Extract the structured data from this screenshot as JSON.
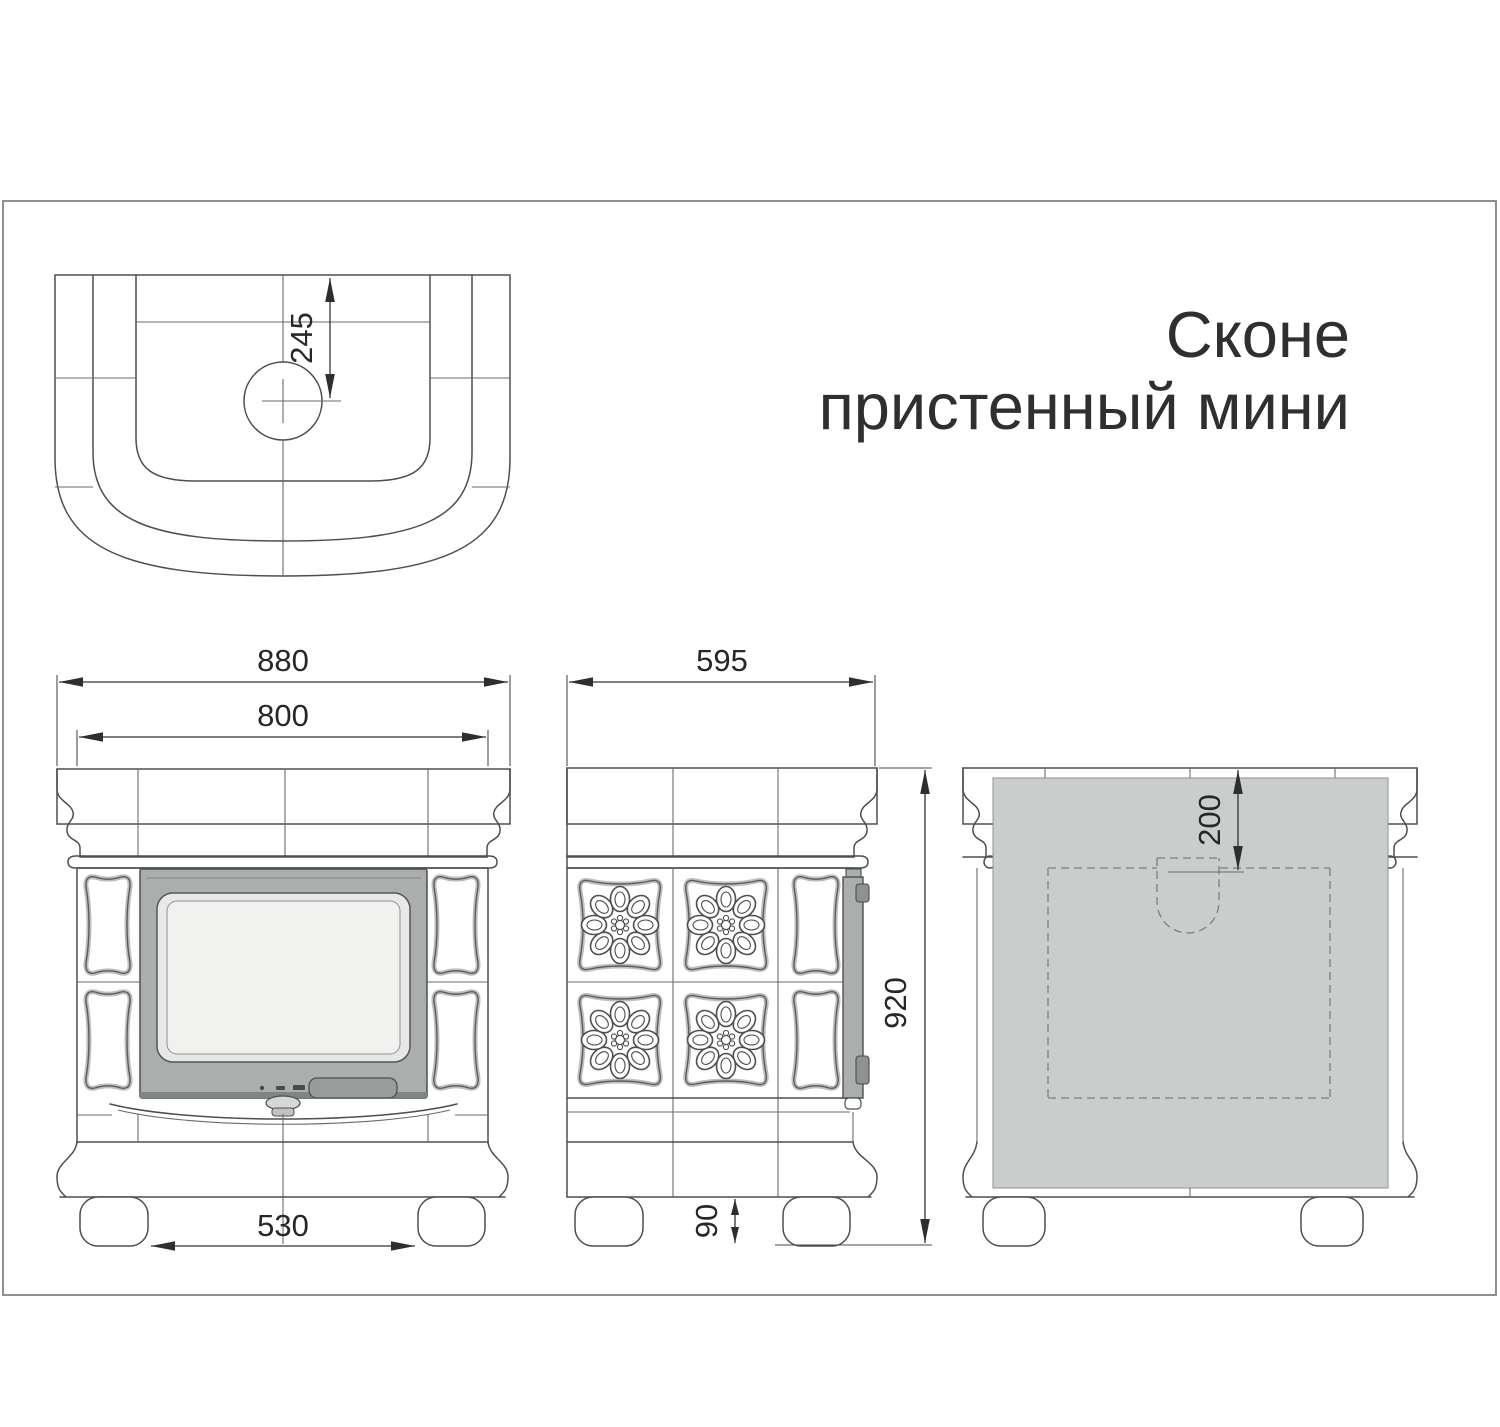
{
  "title": {
    "line1": "Сконе",
    "line2": "пристенный мини"
  },
  "drawing": {
    "top_view": {
      "dim_flue_center_offset": "245"
    },
    "front_view": {
      "dim_overall_width": "880",
      "dim_body_width": "800",
      "dim_feet_inner_spacing": "530"
    },
    "side_view": {
      "dim_depth": "595",
      "dim_height": "920",
      "dim_foot_height": "90"
    },
    "rear_view": {
      "dim_flue_top_offset": "200"
    }
  },
  "colors": {
    "line": "#4e4e4e",
    "door_frame_gray": "#aaaead",
    "door_glass": "#f1f1f0",
    "control_gray": "#989c9b",
    "hinge_gray": "#8e9291",
    "rear_panel_gray": "#c9cdcc",
    "frame_border": "#8f8f8f"
  }
}
